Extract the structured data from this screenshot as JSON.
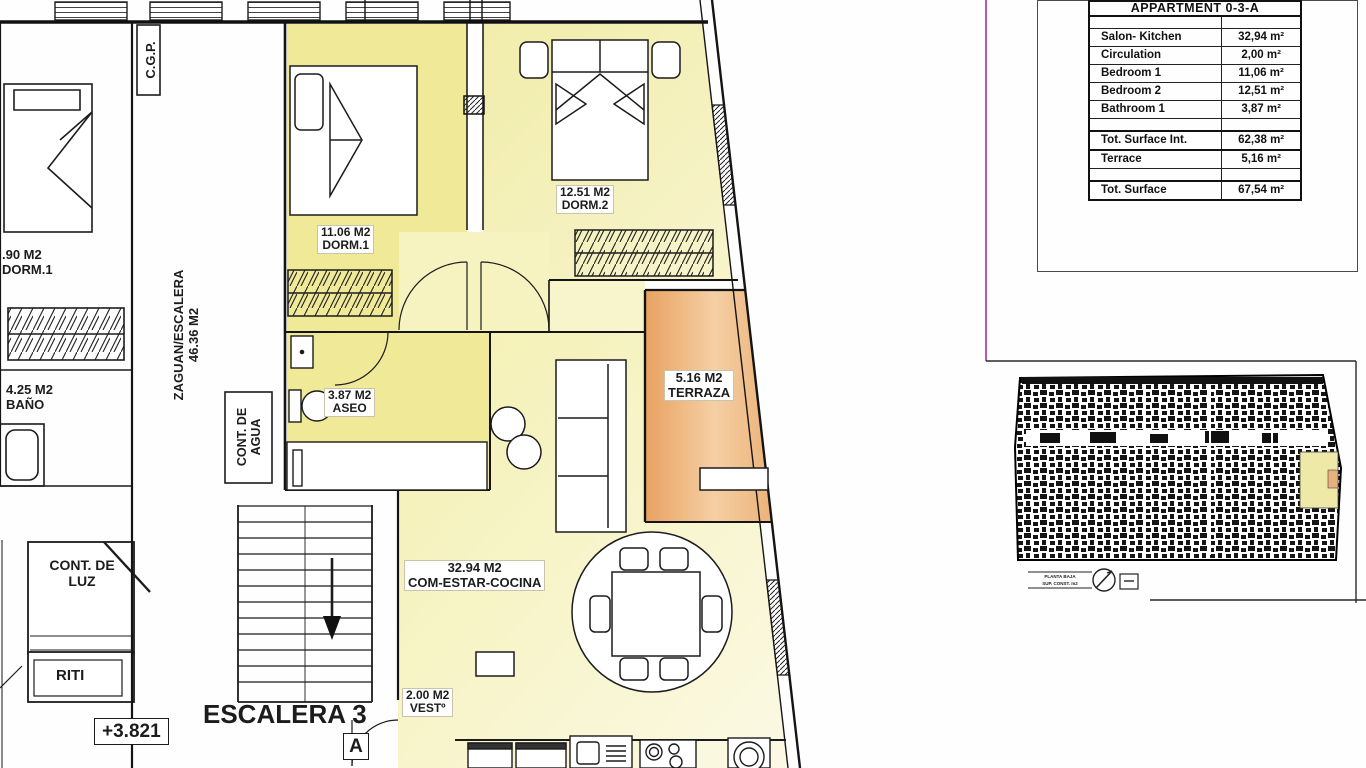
{
  "summary_table": {
    "title": "APPARTMENT 0-3-A",
    "rows": [
      {
        "label": "Salon- Kitchen",
        "value": "32,94 m²"
      },
      {
        "label": "Circulation",
        "value": "2,00 m²"
      },
      {
        "label": "Bedroom 1",
        "value": "11,06 m²"
      },
      {
        "label": "Bedroom 2",
        "value": "12,51 m²"
      },
      {
        "label": "Bathroom 1",
        "value": "3,87 m²"
      }
    ],
    "total_interior": {
      "label": "Tot. Surface Int.",
      "value": "62,38 m²"
    },
    "terrace": {
      "label": "Terrace",
      "value": "5,16 m²"
    },
    "total": {
      "label": "Tot. Surface",
      "value": "67,54 m²"
    }
  },
  "plan_labels": {
    "dorm1_area": "11.06 M2",
    "dorm1_name": "DORM.1",
    "dorm2_area": "12.51 M2",
    "dorm2_name": "DORM.2",
    "aseo_area": "3.87 M2",
    "aseo_name": "ASEO",
    "terraza_area": "5.16 M2",
    "terraza_name": "TERRAZA",
    "salon_area": "32.94 M2",
    "salon_name": "COM-ESTAR-COCINA",
    "vest_area": "2.00 M2",
    "vest_name": "VESTº",
    "escalera": "ESCALERA 3",
    "stair_letter": "A",
    "level": "+3.821",
    "cgp": "C.G.P.",
    "zaguan_name": "ZAGUAN/ESCALERA",
    "zaguan_area": "46.36 M2",
    "cont_agua_1": "CONT. DE",
    "cont_agua_2": "AGUA",
    "cont_luz_1": "CONT. DE",
    "cont_luz_2": "LUZ",
    "riti": "RITI",
    "neighbor_dorm_area": ".90 M2",
    "neighbor_dorm_name": "DORM.1",
    "neighbor_bano_area": "4.25 M2",
    "neighbor_bano_name": "BAÑO"
  },
  "keyplan": {
    "caption_1": "PLANTA BAJA",
    "caption_2": "SUP. CONST. m2"
  },
  "colors": {
    "accent_magenta": "#b75ab7",
    "room_yellow": "#efe998",
    "room_pale": "#f7f4c4",
    "terrace_orange": "#eaa766",
    "highlight_yellow": "#efe9a8"
  }
}
